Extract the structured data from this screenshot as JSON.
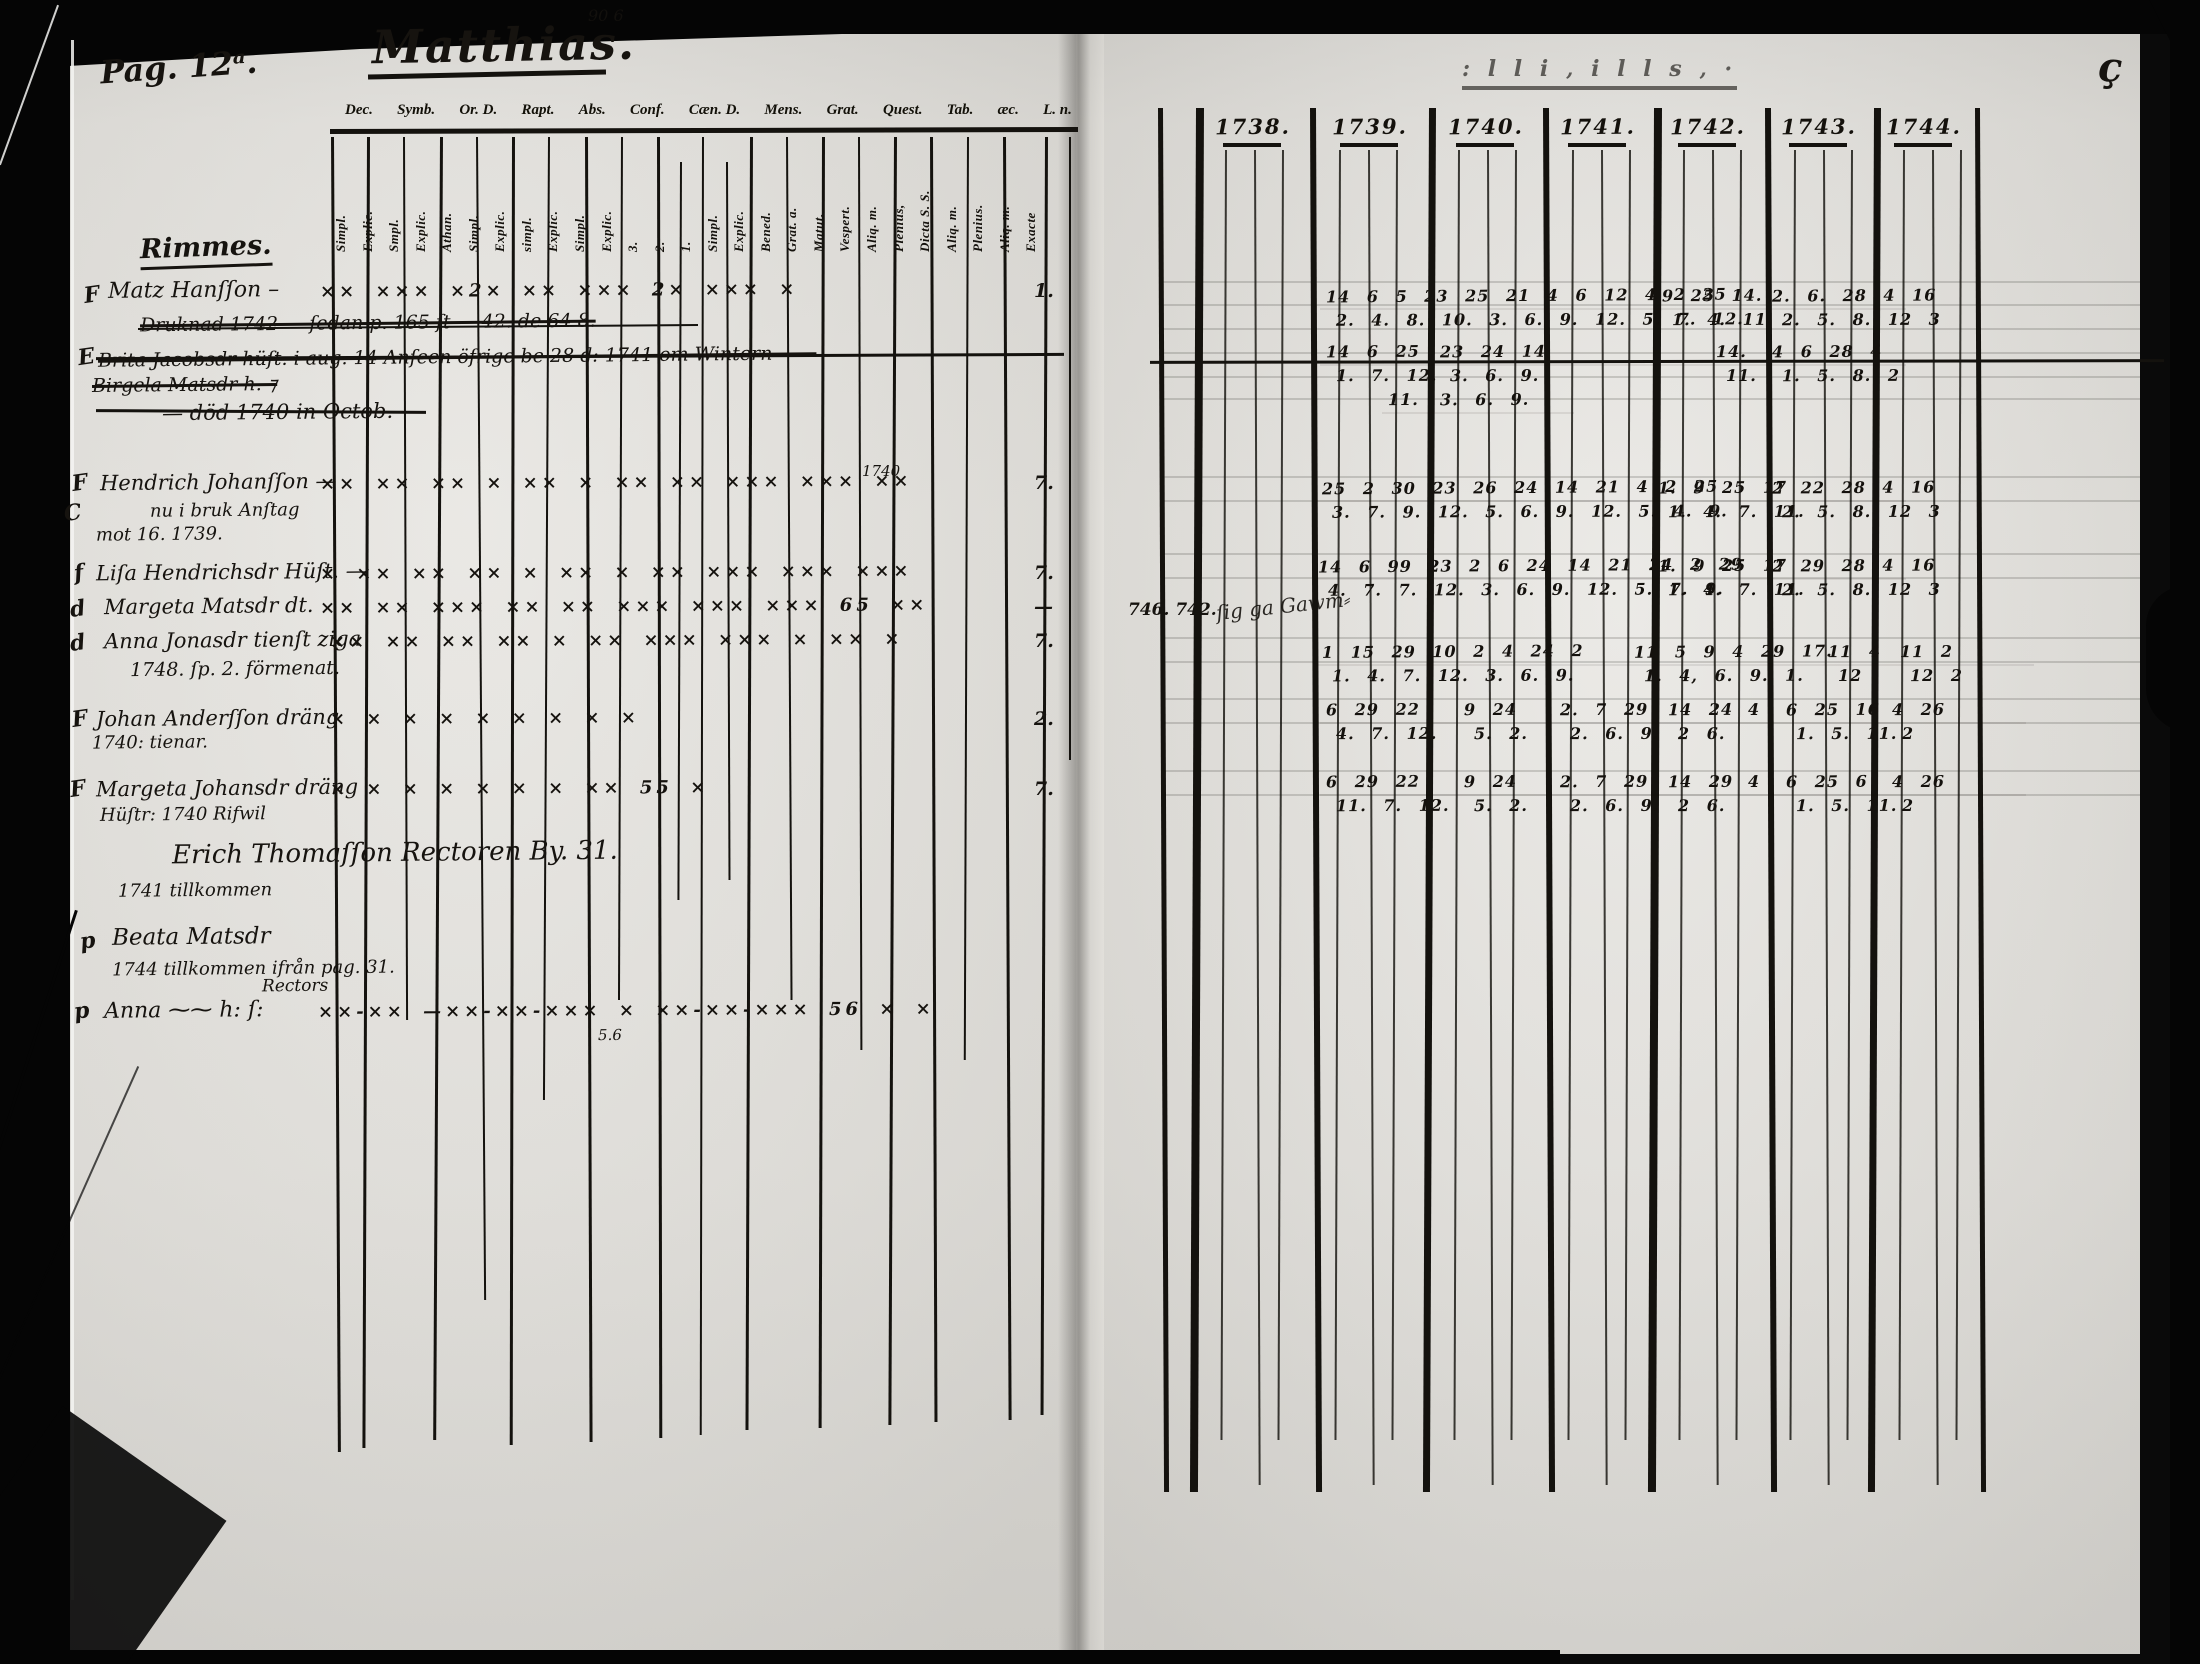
{
  "page_label": "Pag. 12ᵃ.",
  "title": "Matthias.",
  "top_note": "90  6",
  "bleed_note": ": l l i ‚ i l l s ‚            ·",
  "corner_mark": "ç",
  "header_abbrevs": [
    "Dec.",
    "Symb.",
    "Or. D.",
    "Rapt.",
    "Abs.",
    "Conf.",
    "Cæn. D.",
    "Mens.",
    "Grat.",
    "Quest.",
    "Tab.",
    "æc.",
    "L. n."
  ],
  "column_labels": [
    "Simpl.",
    "Explic.",
    "Smpl.",
    "Explic.",
    "Athan.",
    "Simpl.",
    "Explic.",
    "simpl.",
    "Explic.",
    "Simpl.",
    "Explic.",
    "3.",
    "2.",
    "1.",
    "Simpl.",
    "Explic.",
    "Bened.",
    "Grat. a.",
    "Matut.",
    "Vespert.",
    "Aliq. m.",
    "Plenius,",
    "Dicta S. S.",
    "Aliq. m.",
    "Plenius.",
    "Aliq. m.",
    "Exacte"
  ],
  "section_heading": "Rimmes.",
  "years": [
    "1738.",
    "1739.",
    "1740.",
    "1741.",
    "1742.",
    "1743.",
    "1744."
  ],
  "side_annotation": "746. 742.",
  "side_annotation_scribble": "ſig ga Gawm⸗",
  "margin_marks": [
    {
      "t": "F",
      "x": 84,
      "y": 282
    },
    {
      "t": "E",
      "x": 78,
      "y": 344
    },
    {
      "t": "F",
      "x": 72,
      "y": 470
    },
    {
      "t": "C",
      "x": 64,
      "y": 500
    },
    {
      "t": "f",
      "x": 74,
      "y": 560
    },
    {
      "t": "d",
      "x": 70,
      "y": 596
    },
    {
      "t": "d",
      "x": 70,
      "y": 630
    },
    {
      "t": "F",
      "x": 72,
      "y": 706
    },
    {
      "t": "F",
      "x": 70,
      "y": 776
    },
    {
      "t": "p",
      "x": 80,
      "y": 928
    },
    {
      "t": "p",
      "x": 74,
      "y": 998
    }
  ],
  "entries": [
    {
      "x": 108,
      "y": 278,
      "s": 22,
      "text": "Matz Hanſſon –",
      "marks": "×× ××× ×2× ×× ×××  2×  ××× ×",
      "marksX": 320,
      "right": "1."
    },
    {
      "x": 140,
      "y": 312,
      "s": 19,
      "struck": true,
      "text": "Druknad 1742 — ſedan p. 165 ſt — 42. de 64 8."
    },
    {
      "x": 98,
      "y": 346,
      "s": 19,
      "struck": true,
      "text": "Brita Jacobsdr hüſt. i aug. 14 Anſeen öfrige be 28 d: 1741 om Wintern ——"
    },
    {
      "x": 92,
      "y": 374,
      "s": 19,
      "struck": true,
      "text": "Birgela Matsdr h. ⁊"
    },
    {
      "x": 162,
      "y": 400,
      "s": 21,
      "text": "—  död 1740 in Octob."
    },
    {
      "x": 100,
      "y": 470,
      "s": 21,
      "text": "Hendrich Johanſſon —",
      "marks": "×× ×× ×× × ××  × ×× ×× ××× ××× ××",
      "marksX": 320,
      "right": "7.",
      "extra": {
        "t": "1740",
        "x": 862,
        "y": 462,
        "s": 15
      }
    },
    {
      "x": 150,
      "y": 500,
      "s": 18,
      "text": "nu i bruk Anſtag"
    },
    {
      "x": 96,
      "y": 524,
      "s": 18,
      "text": "mot 16. 1739."
    },
    {
      "x": 96,
      "y": 560,
      "s": 21,
      "text": "Liſa Hendrichsdr Hüſt. —",
      "marks": "× ×× ×× ×× ×  ×× × ×× ××× ××× ×××",
      "marksX": 320,
      "right": "7."
    },
    {
      "x": 104,
      "y": 594,
      "s": 21,
      "text": "Margeta Matsdr dt.",
      "marks": "×× ×× ××× ×× ×× ××× ××× ××× 65 ××",
      "marksX": 320,
      "right": "—"
    },
    {
      "x": 104,
      "y": 628,
      "s": 21,
      "text": "Anna Jonasdr tienſt ziga",
      "marks": "×× ×× ×× ×× ×  ×× ××× ××× ×  ×× ×",
      "marksX": 330,
      "right": "7."
    },
    {
      "x": 130,
      "y": 658,
      "s": 19,
      "text": "1748. ſp. 2. förmenat."
    },
    {
      "x": 96,
      "y": 706,
      "s": 21,
      "text": "Johan Anderſſon dräng",
      "marks": "×  ×  ×  ×   ×  ×  ×   ×  ×",
      "marksX": 330,
      "right": "2."
    },
    {
      "x": 92,
      "y": 732,
      "s": 18,
      "text": "1740: tienar."
    },
    {
      "x": 96,
      "y": 776,
      "s": 21,
      "text": "Margeta Johansdr dräng",
      "marks": "×  ×  ×  ×   ×  ×  ×  ×× 55 ×",
      "marksX": 330,
      "right": "7."
    },
    {
      "x": 100,
      "y": 804,
      "s": 18,
      "text": "Hüſtr: 1740 Rifwil"
    },
    {
      "x": 172,
      "y": 838,
      "s": 26,
      "text": "Erich Thomaſſon    Rectoren    By. 31."
    },
    {
      "x": 118,
      "y": 880,
      "s": 18,
      "text": "1741 tillkommen"
    },
    {
      "x": 112,
      "y": 924,
      "s": 23,
      "text": "Beata Matsdr"
    },
    {
      "x": 112,
      "y": 958,
      "s": 18,
      "text": "1744 tillkommen ifrån pag. 31."
    },
    {
      "x": 262,
      "y": 976,
      "s": 17,
      "text": "Rectors"
    },
    {
      "x": 104,
      "y": 998,
      "s": 22,
      "text": "Anna  ⁓⁓  h: ſ:",
      "marks": "××-××  —××-××-×××   ×    ××-××-××× 56 ×   ×",
      "marksX": 318
    },
    {
      "x": 598,
      "y": 1026,
      "s": 15,
      "text": "5.6"
    }
  ],
  "grid_rows": [
    {
      "ty": 286,
      "cells": [
        {
          "x": 1326,
          "t": "14 6 5 23 25 21 4 6 12 4 2 25",
          "b": "2. 4. 8. 10. 3. 6. 9. 12. 5. 7. 12."
        },
        {
          "x": 1662,
          "t": "9 25 14.",
          "b": "1. 4. 11."
        },
        {
          "x": 1772,
          "t": "2. 6. 28 4 16",
          "b": "2. 5. 8. 12 3"
        }
      ]
    },
    {
      "ty": 342,
      "cells": [
        {
          "x": 1326,
          "t": "14 6 25",
          "b": "1. 7. 12."
        },
        {
          "x": 1440,
          "t": "23 24 14",
          "b": "3. 6. 9."
        },
        {
          "x": 1716,
          "t": "14.",
          "b": "11."
        },
        {
          "x": 1772,
          "t": "4 6 28 4",
          "b": "1. 5. 8. 2"
        }
      ]
    },
    {
      "ty": 390,
      "cells": [
        {
          "x": 1388,
          "t": "11.",
          "b": ""
        },
        {
          "x": 1440,
          "t": "3. 6. 9.",
          "b": ""
        }
      ]
    },
    {
      "ty": 478,
      "cells": [
        {
          "x": 1322,
          "t": "25 2 30 23 26 24 14 21 4 2 25",
          "b": "3. 7. 9. 12. 5. 6. 9. 12. 5. 4. 9."
        },
        {
          "x": 1658,
          "t": "1. 9 25 17",
          "b": "1. 4. 7. 11."
        },
        {
          "x": 1772,
          "t": "2 22 28 4 16",
          "b": "2. 5. 8. 12 3"
        }
      ]
    },
    {
      "ty": 556,
      "cells": [
        {
          "x": 1318,
          "t": "14 6 99 23 2 6 24 14 21 24 2 29",
          "b": "4. 7. 7. 12. 3. 6. 9. 12. 5. 7. 9."
        },
        {
          "x": 1658,
          "t": "1. 9 25 17",
          "b": "1. 4. 7. 11."
        },
        {
          "x": 1772,
          "t": "2 29 28 4 16",
          "b": "2. 5. 8. 12 3"
        }
      ]
    },
    {
      "ty": 642,
      "cells": [
        {
          "x": 1322,
          "t": "1 15 29 10 2 4 24 2",
          "b": "1. 4. 7. 12. 3. 6. 9."
        },
        {
          "x": 1634,
          "t": "11 5 9 4 29 17.",
          "b": "1. 4, 6. 9. 1."
        },
        {
          "x": 1828,
          "t": "11 4",
          "b": "12"
        },
        {
          "x": 1900,
          "t": "11 2",
          "b": "12 2"
        }
      ]
    },
    {
      "ty": 700,
      "cells": [
        {
          "x": 1326,
          "t": "6 29 22",
          "b": "4. 7. 12."
        },
        {
          "x": 1464,
          "t": "9 24",
          "b": "5. 2."
        },
        {
          "x": 1560,
          "t": "2. 7 29",
          "b": "2. 6. 9."
        },
        {
          "x": 1668,
          "t": "14 24",
          "b": "2 6."
        },
        {
          "x": 1748,
          "t": "4",
          "b": ""
        },
        {
          "x": 1786,
          "t": "6 25 16",
          "b": "1. 5. 11."
        },
        {
          "x": 1892,
          "t": "4 26",
          "b": "2"
        }
      ]
    },
    {
      "ty": 772,
      "cells": [
        {
          "x": 1326,
          "t": "6 29 22",
          "b": "11. 7. 12."
        },
        {
          "x": 1464,
          "t": "9 24",
          "b": "5. 2."
        },
        {
          "x": 1560,
          "t": "2. 7 29",
          "b": "2. 6. 9."
        },
        {
          "x": 1668,
          "t": "14 29",
          "b": "2 6."
        },
        {
          "x": 1748,
          "t": "4",
          "b": ""
        },
        {
          "x": 1786,
          "t": "6 25 6",
          "b": "1. 5. 11."
        },
        {
          "x": 1892,
          "t": "4 26",
          "b": "2"
        }
      ]
    }
  ]
}
